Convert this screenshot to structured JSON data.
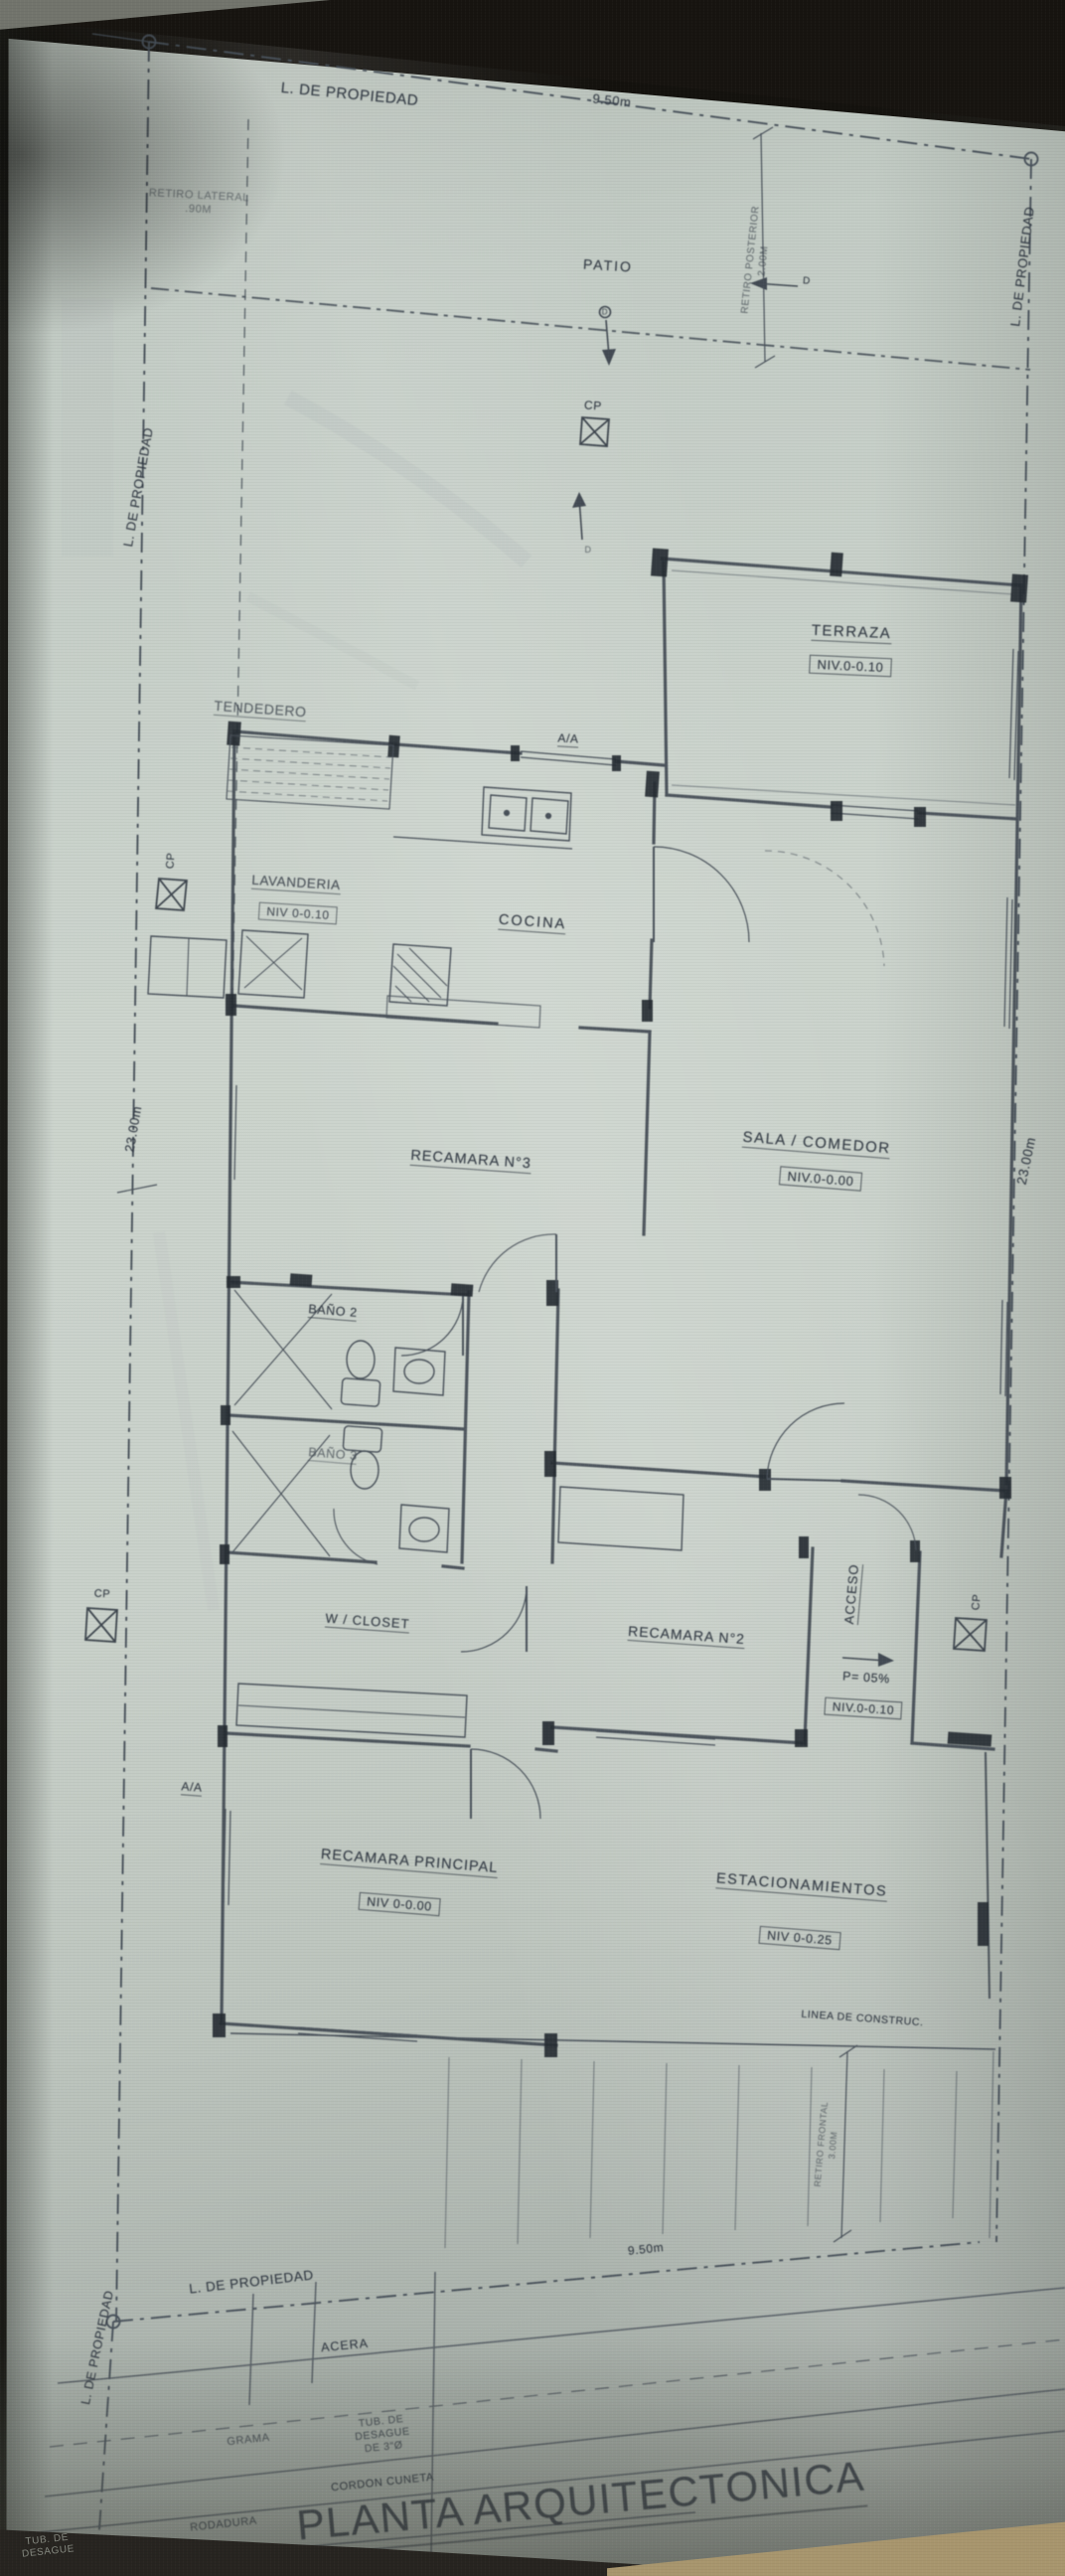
{
  "drawing": {
    "title": "PLANTA ARQUITECTONICA",
    "rooms": {
      "patio": {
        "name": "PATIO"
      },
      "terraza": {
        "name": "TERRAZA",
        "nivel": "NIV.0-0.10"
      },
      "tendedero": {
        "name": "TENDEDERO"
      },
      "lavanderia": {
        "name": "LAVANDERIA",
        "nivel": "NIV 0-0.10"
      },
      "cocina": {
        "name": "COCINA"
      },
      "sala_comedor": {
        "name": "SALA / COMEDOR",
        "nivel": "NIV.0-0.00"
      },
      "recamara_3": {
        "name": "RECAMARA N°3"
      },
      "bano_2": {
        "name": "BAÑO 2"
      },
      "bano_3": {
        "name": "BAÑO 3"
      },
      "w_closet": {
        "name": "W / CLOSET"
      },
      "recamara_2": {
        "name": "RECAMARA N°2"
      },
      "acceso": {
        "name": "ACCESO",
        "pendiente": "P= 05%",
        "nivel": "NIV.0-0.10"
      },
      "recamara_principal": {
        "name": "RECAMARA PRINCIPAL",
        "nivel": "NIV 0-0.00"
      },
      "estacionamientos": {
        "name": "ESTACIONAMIENTOS",
        "nivel": "NIV 0-0.25"
      }
    },
    "site": {
      "property_line": "L. DE PROPIEDAD",
      "width_dim": "9.50m",
      "depth_dim": "23.00m",
      "retiro_lateral": "RETIRO LATERAL",
      "retiro_lateral_value": ".90M",
      "retiro_posterior": "RETIRO POSTERIOR",
      "retiro_posterior_value": "2.00M",
      "retiro_frontal": "RETIRO FRONTAL",
      "retiro_frontal_value": "3.00M",
      "linea_construccion": "LINEA DE CONSTRUC.",
      "cp_marker": "CP",
      "drain_marker": "D",
      "ac_unit": "A/A"
    },
    "street": {
      "acera": "ACERA",
      "grama": "GRAMA",
      "tub_desague_1": "TUB. DE",
      "tub_desague_2": "DESAGUE",
      "tub_desague_3": "DE 3\"Ø",
      "cordon_cuneta": "CORDON CUNETA",
      "rodadura": "RODADURA",
      "corner_note_1": "TUB. DE",
      "corner_note_2": "DESAGUE"
    },
    "colors": {
      "paper": "#c6cec7",
      "ink": "#3d454f",
      "shadow": "#171410"
    }
  }
}
